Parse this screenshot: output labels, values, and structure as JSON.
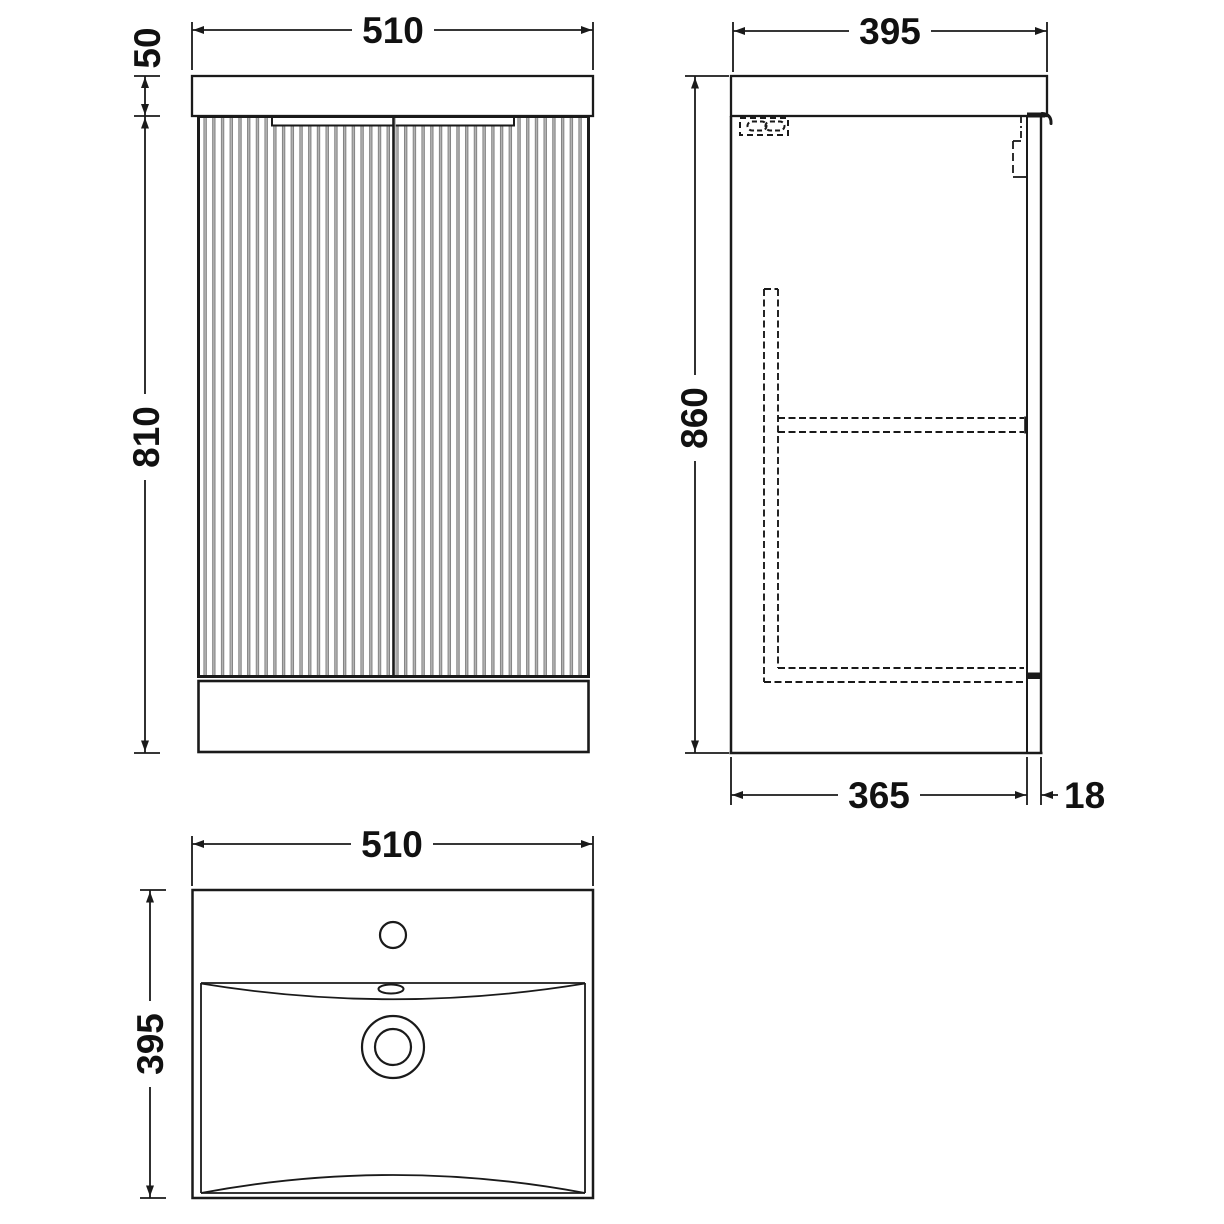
{
  "drawing": {
    "type": "vanity-unit-technical-drawing",
    "dims": {
      "front_width": "510",
      "front_worktop_height": "50",
      "front_cabinet_height": "810",
      "side_depth": "395",
      "side_height": "860",
      "side_cabinet_depth": "365",
      "side_door_thickness": "18",
      "plan_width": "510",
      "plan_depth": "395"
    },
    "colors": {
      "line": "#1a1a1a",
      "flute_edge": "#757575",
      "flute_fill": "#b3b3b3",
      "background": "#ffffff"
    }
  }
}
